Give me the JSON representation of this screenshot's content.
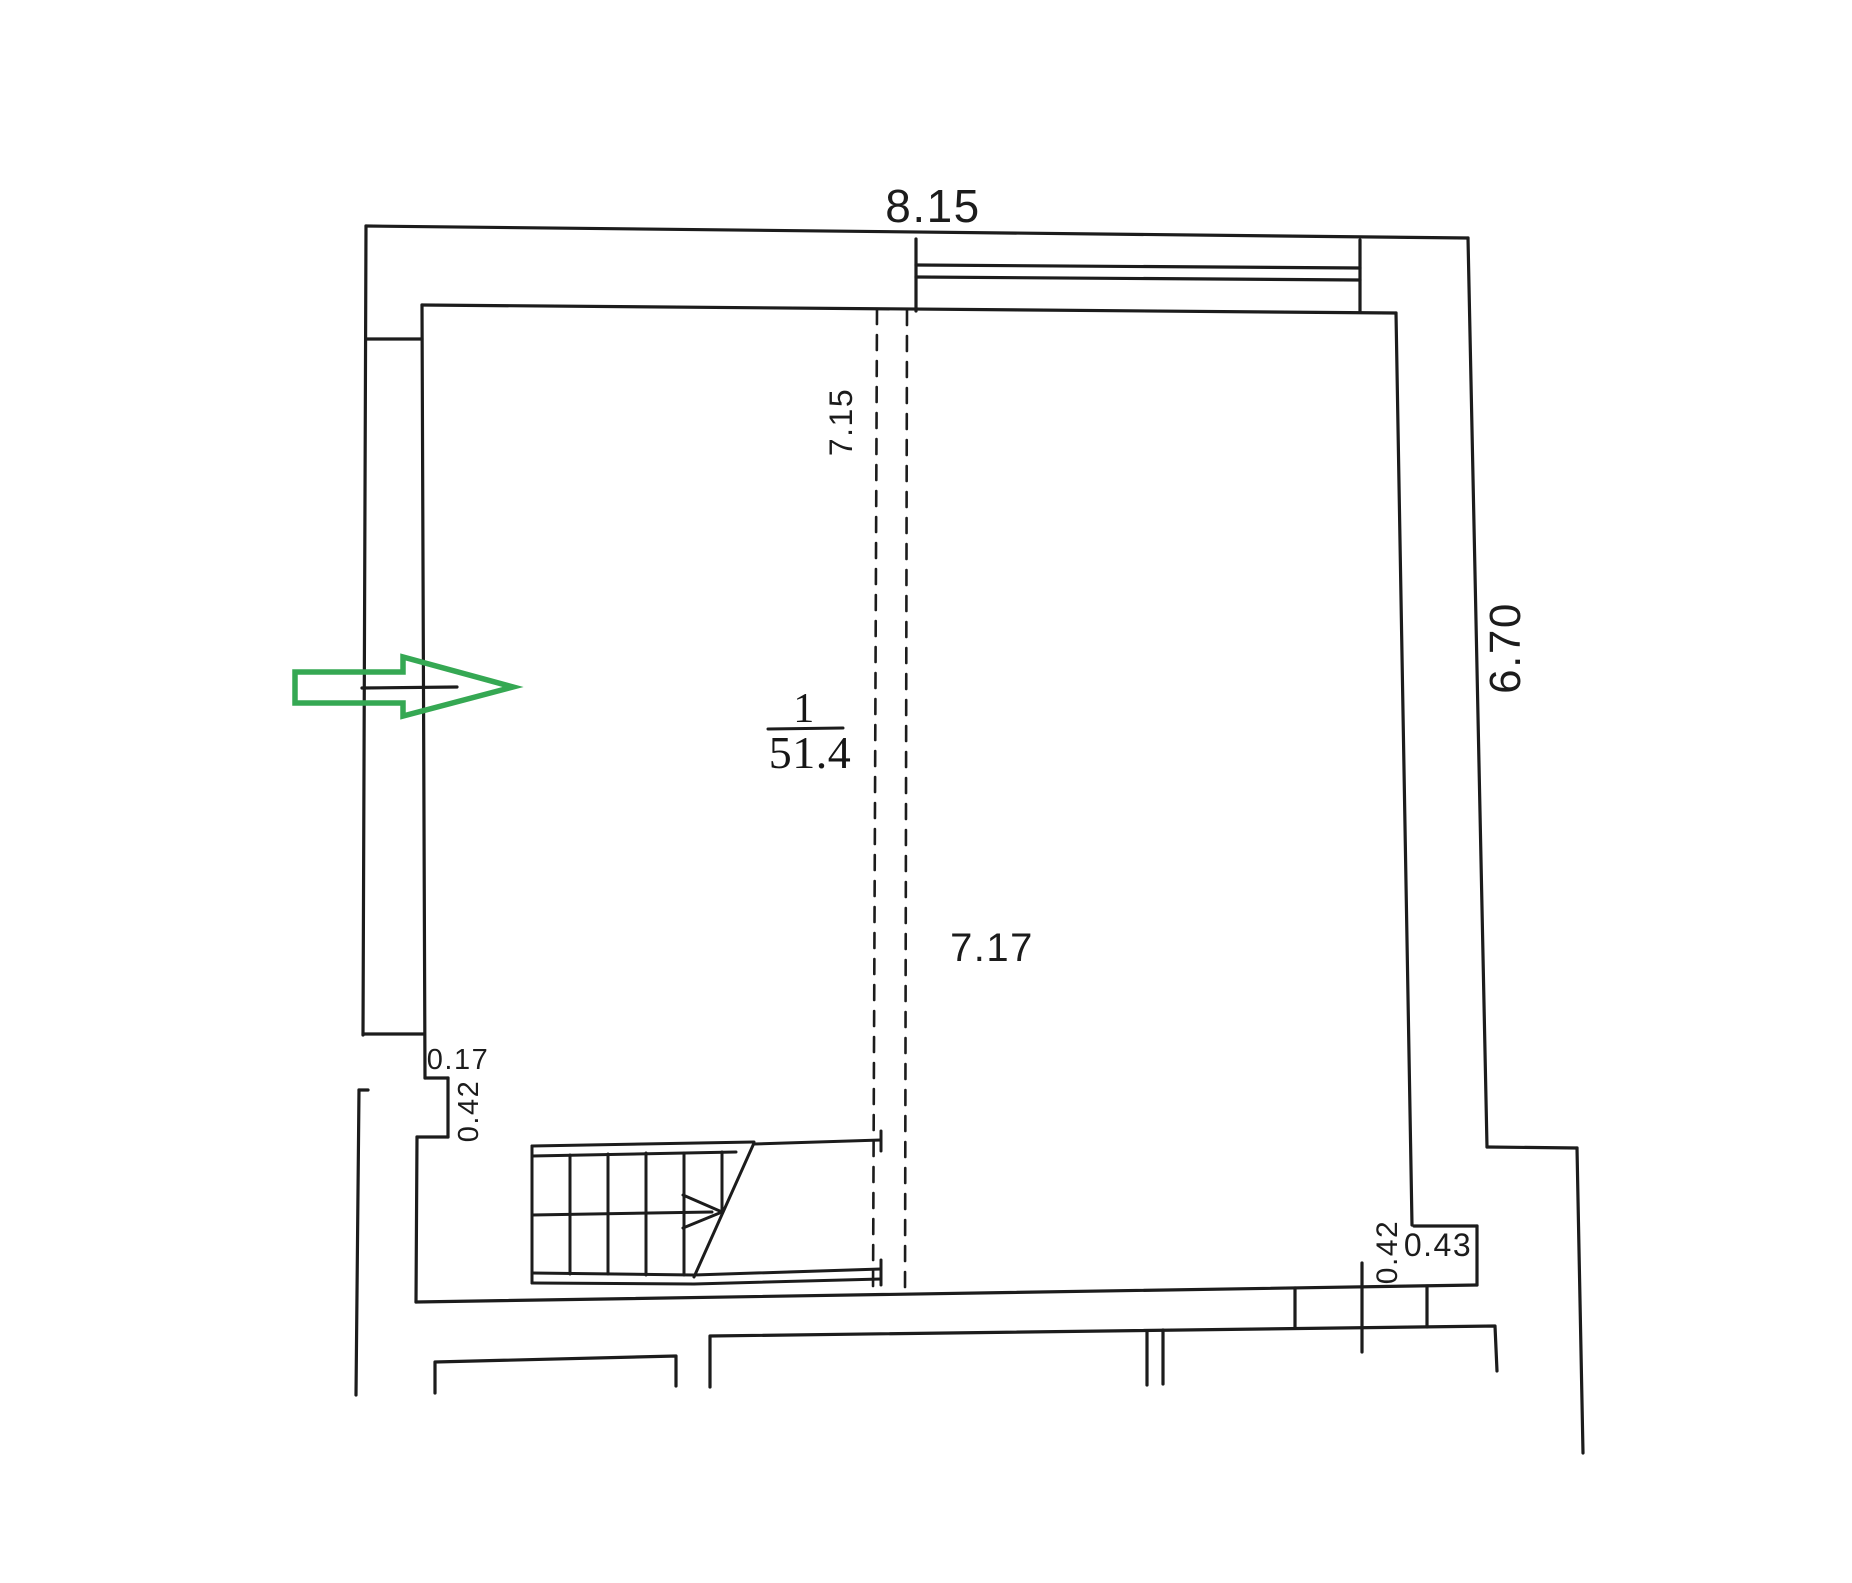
{
  "drawing": {
    "dimensions": {
      "top_width": "8.15",
      "right_height": "6.70",
      "room_width_left": "7.15",
      "room_width_right": "7.17",
      "left_step_depth": "0.17",
      "left_step_height": "0.42",
      "right_step_height": "0.42",
      "right_step_width": "0.43"
    },
    "room": {
      "number": "1",
      "area": "51.4"
    },
    "colors": {
      "line": "#1c1c1c",
      "arrow_green": "#35a853",
      "background": "#ffffff"
    }
  }
}
